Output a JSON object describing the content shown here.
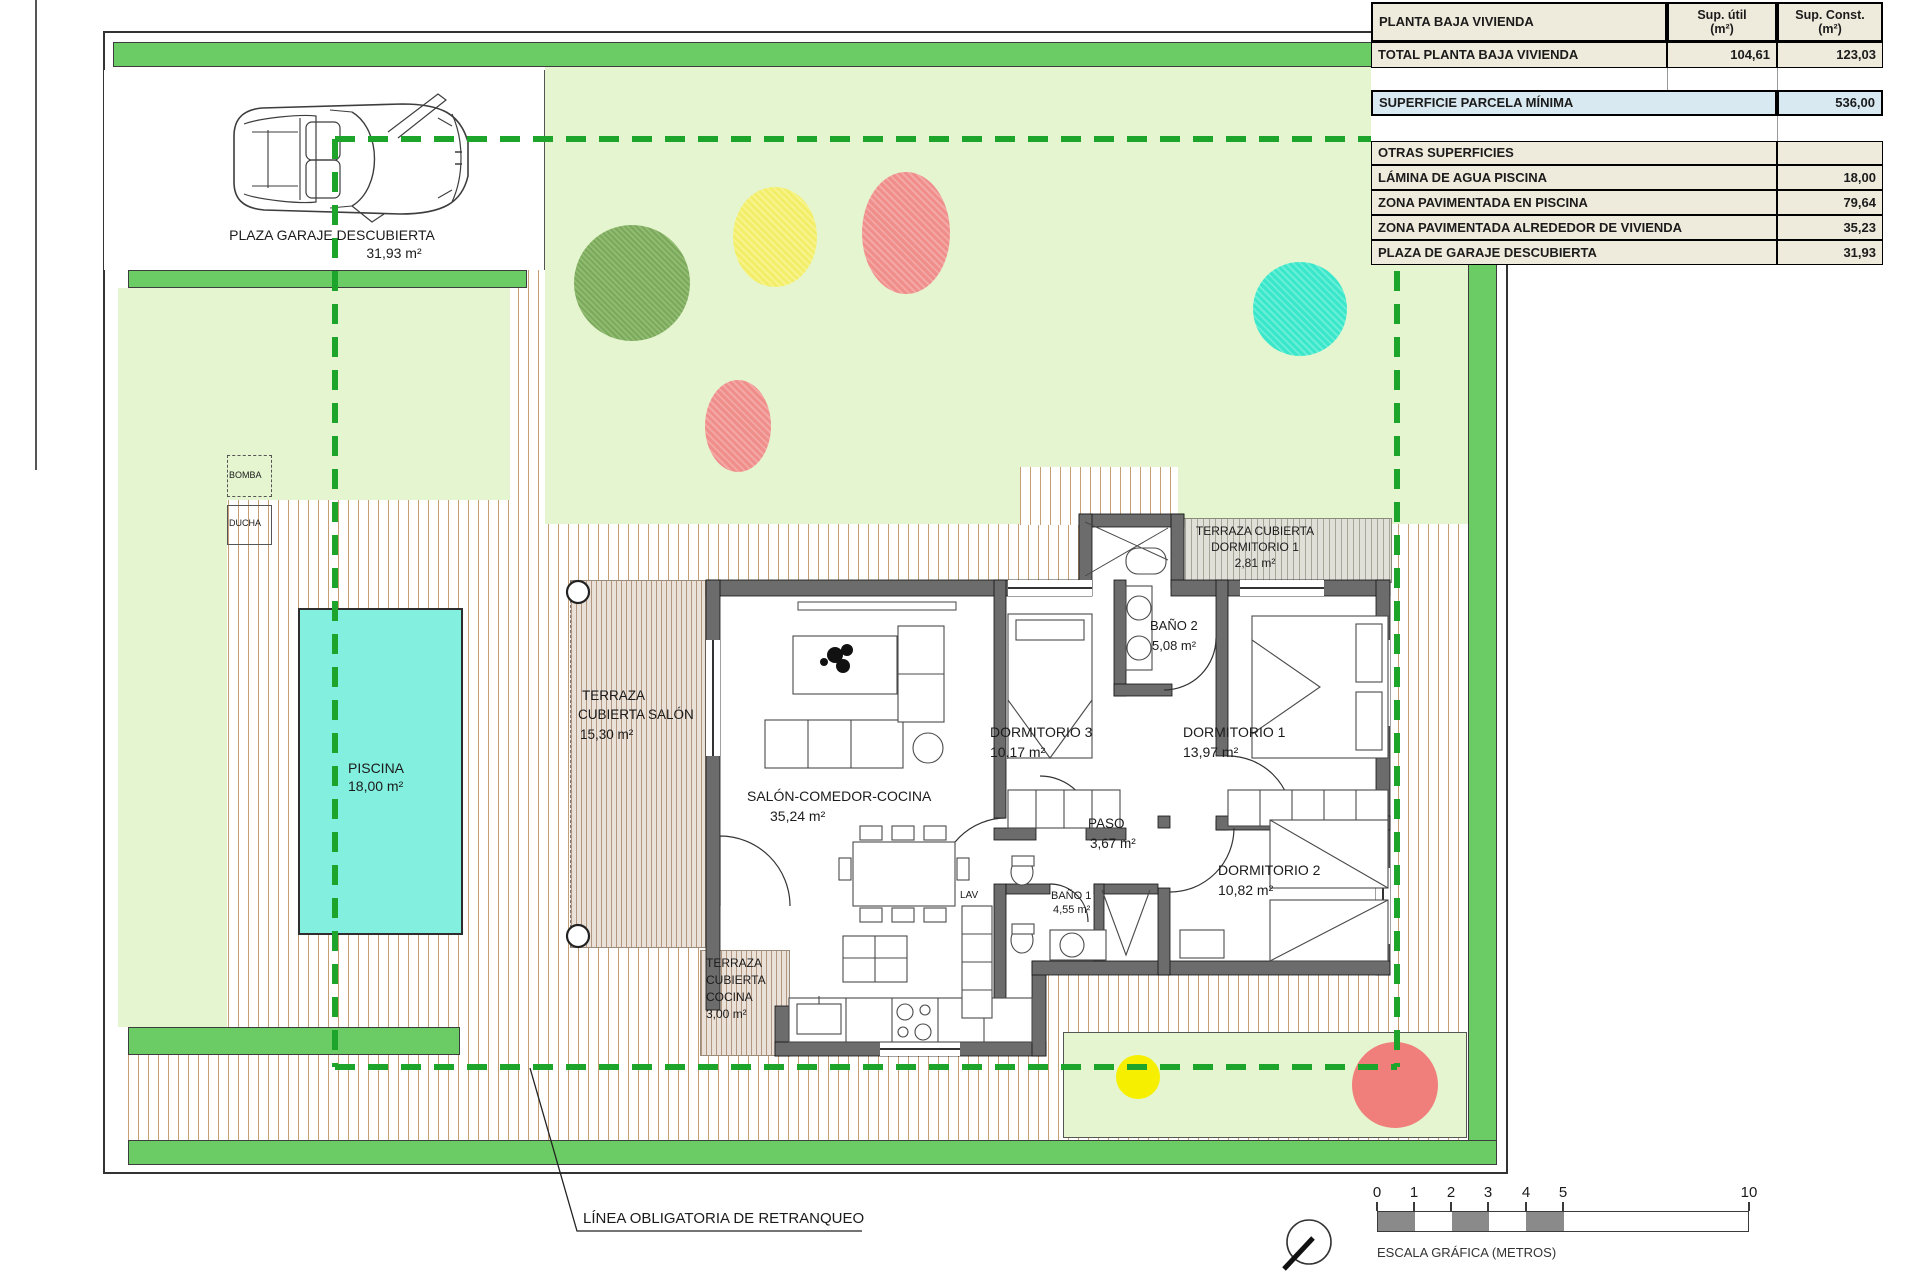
{
  "table": {
    "title": "PLANTA BAJA VIVIENDA",
    "col_util": "Sup. útil\n(m²)",
    "col_const": "Sup. Const.\n(m²)",
    "total_row": {
      "label": "TOTAL PLANTA BAJA VIVIENDA",
      "util": "104,61",
      "const": "123,03"
    },
    "parcela_row": {
      "label": "SUPERFICIE PARCELA MÍNIMA",
      "value": "536,00"
    },
    "otras_title": "OTRAS SUPERFICIES",
    "otras_rows": [
      {
        "label": "LÁMINA DE AGUA PISCINA",
        "value": "18,00"
      },
      {
        "label": "ZONA PAVIMENTADA EN PISCINA",
        "value": "79,64"
      },
      {
        "label": "ZONA PAVIMENTADA ALREDEDOR DE VIVIENDA",
        "value": "35,23"
      },
      {
        "label": "PLAZA DE GARAJE DESCUBIERTA",
        "value": "31,93"
      }
    ]
  },
  "site": {
    "garage": {
      "label": "PLAZA GARAJE DESCUBIERTA",
      "area": "31,93 m²"
    },
    "pool": {
      "label": "PISCINA",
      "area": "18,00 m²"
    },
    "bomba": "BOMBA",
    "ducha": "DUCHA",
    "lav": "LAV",
    "setback_label": "LÍNEA OBLIGATORIA DE RETRANQUEO"
  },
  "rooms": {
    "terraza_salon": {
      "l1": "TERRAZA",
      "l2": "CUBIERTA SALÓN",
      "area": "15,30 m²"
    },
    "salon": {
      "label": "SALÓN-COMEDOR-COCINA",
      "area": "35,24 m²"
    },
    "dormitorio3": {
      "label": "DORMITORIO 3",
      "area": "10,17 m²"
    },
    "bano2": {
      "label": "BAÑO 2",
      "area": "5,08 m²"
    },
    "dormitorio1": {
      "label": "DORMITORIO 1",
      "area": "13,97 m²"
    },
    "terraza_dorm1": {
      "l1": "TERRAZA CUBIERTA",
      "l2": "DORMITORIO 1",
      "area": "2,81 m²"
    },
    "paso": {
      "label": "PASO",
      "area": "3,67 m²"
    },
    "bano1": {
      "label": "BAÑO 1",
      "area": "4,55 m²"
    },
    "dormitorio2": {
      "label": "DORMITORIO 2",
      "area": "10,82 m²"
    },
    "terraza_cocina": {
      "l1": "TERRAZA",
      "l2": "CUBIERTA",
      "l3": "COCINA",
      "area": "3,00 m²"
    }
  },
  "scale_bar": {
    "ticks": [
      "0",
      "1",
      "2",
      "3",
      "4",
      "5",
      "10"
    ],
    "label": "ESCALA GRÁFICA (METROS)"
  },
  "colors": {
    "band_green": "#6BCB64",
    "garden_green": "#E4F5CF",
    "setback_green": "#1CA42B",
    "pool_cyan": "#82EFDF",
    "wall_gray": "#6C6C6C",
    "paving_tan": "#C69F74"
  }
}
